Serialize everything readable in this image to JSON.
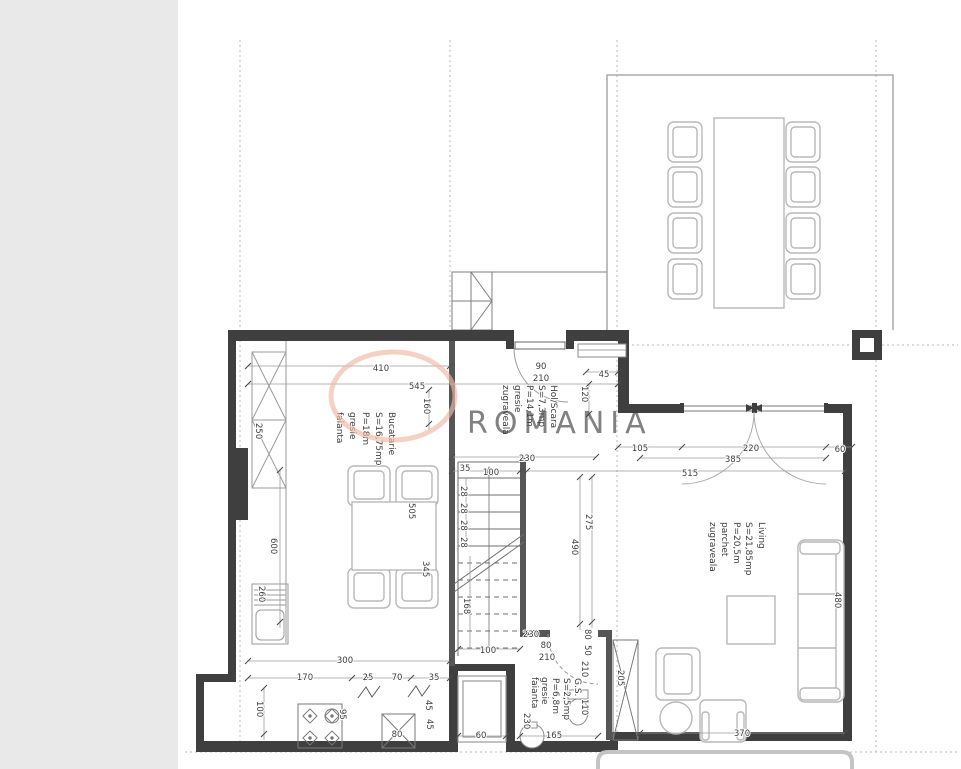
{
  "watermark": {
    "text": "ROMANIA"
  },
  "rooms": {
    "kitchen": {
      "label": "Bucatarie",
      "area": "S=16,75mp",
      "perimeter": "P=18m",
      "floor": "gresie",
      "finish": "faianta"
    },
    "hall": {
      "label": "Hol/Scara",
      "area": "S=7,3mp",
      "perimeter": "P=14,1m",
      "floor": "gresie",
      "finish": "zugraveala"
    },
    "living": {
      "label": "Living",
      "area": "S=21,85mp",
      "perimeter": "P=20,5m",
      "floor": "parchet",
      "finish": "zugraveala"
    },
    "bathroom": {
      "label": "G.S.",
      "area": "S=2,5mp",
      "perimeter": "P=6,8m",
      "floor": "gresie",
      "finish": "faianta"
    }
  },
  "dims": {
    "kitchen_width": "410",
    "kitchen_width_total": "545",
    "kitchen_recess": "160",
    "cabinet_depth": "250",
    "entry_door_width": "90",
    "entry_door_height": "210",
    "entry_side": "45",
    "entry_side_height": "120",
    "hall_width": "230",
    "stair_offset": "35",
    "stair_width_top": "100",
    "tread_1": "28",
    "tread_2": "28",
    "tread_3": "28",
    "tread_4": "28",
    "stair_run": "168",
    "stair_width_bottom": "100",
    "gs_total_width": "230",
    "gs_door_width": "80",
    "gs_door_height": "210",
    "hall_depth": "275",
    "stair_total_run": "490",
    "win_left": "105",
    "win_door": "220",
    "win_right": "60",
    "win_opening": "385",
    "living_width": "515",
    "sofa_length": "480",
    "living_bottom": "370",
    "wardrobe_len": "205",
    "kitchen_depth": "600",
    "sink_len": "260",
    "table_len": "505",
    "table_side": "345",
    "kitchen_bottom": "300",
    "seg_170": "170",
    "seg_25": "25",
    "seg_70": "70",
    "seg_35": "35",
    "alcove_depth": "100",
    "stove_side": "95",
    "seg_45a": "45",
    "fridge_width": "80",
    "seg_45b": "45",
    "shaft_width": "60",
    "gs_bottom": "165",
    "gs_r_80": "80",
    "gs_r_50": "50",
    "gs_r_210": "210",
    "gs_r_110": "110",
    "gs_inner_height": "230"
  },
  "colors": {
    "wall": "#3f3f3f",
    "sidebar": "#e9e9e9",
    "watermark": "#f0b9a6",
    "line": "#9a9a9a"
  }
}
